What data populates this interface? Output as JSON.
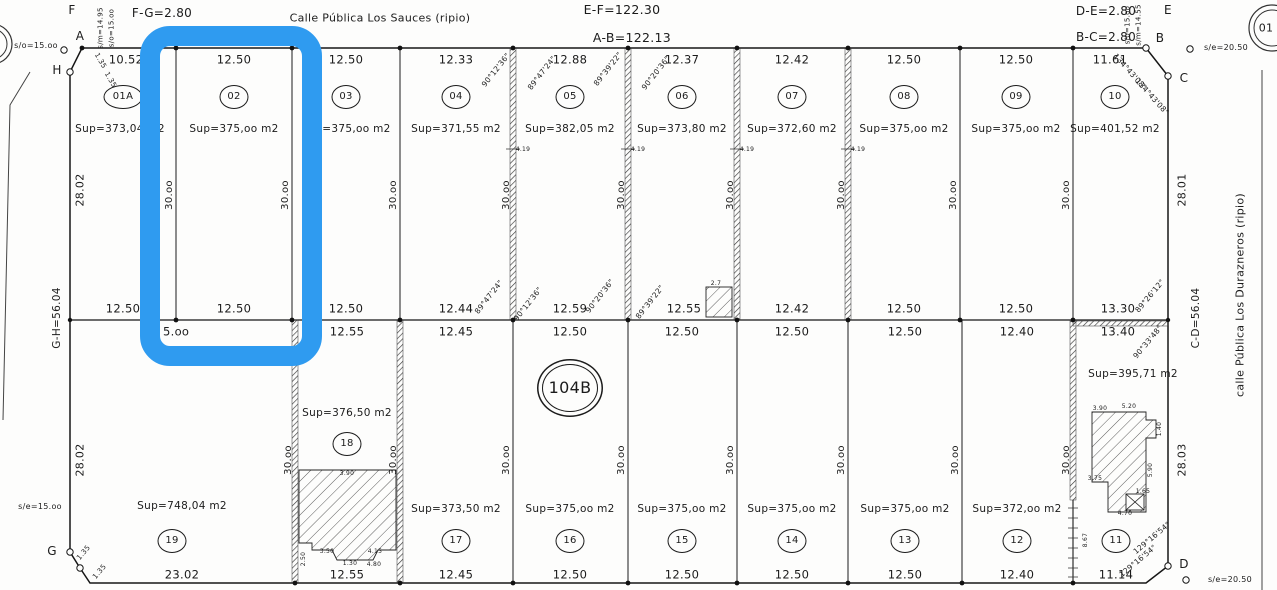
{
  "plan": {
    "block_number": "104B",
    "streets": {
      "top": "Calle Pública Los Sauces (ripio)",
      "right": "calle Pública Los Durazneros (ripio)"
    },
    "perimeter": {
      "ab": "A-B=122.13",
      "ef": "E-F=122.30",
      "gh": "G-H=56.04",
      "cd": "C-D=56.04",
      "fg": "F-G=2.80",
      "bc": "B-C=2.80",
      "de": "D-E=2.80"
    }
  },
  "highlight": {
    "color": "#2f9bf0",
    "target": "lot-02"
  },
  "labels": [
    {
      "n": "vertex-f-label",
      "t": "F",
      "x": 72,
      "y": 10,
      "s": 12
    },
    {
      "n": "dim-f-g",
      "t": "F-G=2.80",
      "x": 162,
      "y": 13,
      "s": 12
    },
    {
      "n": "dim-h-a-partial",
      "t": "H-",
      "x": 199,
      "y": 33,
      "s": 12
    },
    {
      "n": "street-top-label",
      "t": "Calle Pública Los Sauces (ripio)",
      "x": 380,
      "y": 18,
      "s": 11
    },
    {
      "n": "dim-e-f",
      "t": "E-F=122.30",
      "x": 622,
      "y": 10,
      "s": 12.5
    },
    {
      "n": "dim-a-b",
      "t": "A-B=122.13",
      "x": 632,
      "y": 38,
      "s": 12.5
    },
    {
      "n": "dim-d-e",
      "t": "D-E=2.80",
      "x": 1106,
      "y": 11,
      "s": 12
    },
    {
      "n": "dim-b-c",
      "t": "B-C=2.80",
      "x": 1106,
      "y": 37,
      "s": 12
    },
    {
      "n": "vertex-e-label",
      "t": "E",
      "x": 1168,
      "y": 10,
      "s": 12
    },
    {
      "n": "vertex-b-label",
      "t": "B",
      "x": 1160,
      "y": 38,
      "s": 12
    },
    {
      "n": "vertex-c-label",
      "t": "C",
      "x": 1184,
      "y": 78,
      "s": 12
    },
    {
      "n": "vertex-d-label",
      "t": "D",
      "x": 1184,
      "y": 564,
      "s": 12
    },
    {
      "n": "vertex-a-label",
      "t": "A",
      "x": 80,
      "y": 36,
      "s": 12
    },
    {
      "n": "vertex-h-label",
      "t": "H",
      "x": 57,
      "y": 70,
      "s": 12
    },
    {
      "n": "vertex-g-label",
      "t": "G",
      "x": 52,
      "y": 551,
      "s": 12
    },
    {
      "n": "offset-top-left",
      "t": "s/o=15.oo",
      "x": 36,
      "y": 46,
      "s": 8
    },
    {
      "n": "offset-f-1",
      "t": "s/m=14.95",
      "x": 101,
      "y": 28,
      "s": 7,
      "r": -90
    },
    {
      "n": "offset-f-2",
      "t": "s/o=15.oo",
      "x": 112,
      "y": 28,
      "s": 7,
      "r": -90
    },
    {
      "n": "offset-e-1",
      "t": "s/o=15.oo",
      "x": 1128,
      "y": 25,
      "s": 7,
      "r": -90
    },
    {
      "n": "offset-e-2",
      "t": "s/m=14.55",
      "x": 1139,
      "y": 25,
      "s": 7,
      "r": -90
    },
    {
      "n": "offset-top-right",
      "t": "s/e=20.50",
      "x": 1226,
      "y": 48,
      "s": 8
    },
    {
      "n": "offset-bottom-left",
      "t": "s/e=15.oo",
      "x": 40,
      "y": 507,
      "s": 8
    },
    {
      "n": "offset-bottom-right",
      "t": "s/e=20.50",
      "x": 1230,
      "y": 580,
      "s": 8
    },
    {
      "n": "street-right-label",
      "t": "calle Pública Los Durazneros (ripio)",
      "x": 1240,
      "y": 295,
      "s": 11,
      "r": -90
    },
    {
      "n": "adjacent-parcel-number",
      "t": "01",
      "x": 1266,
      "y": 28,
      "s": 11
    },
    {
      "n": "dim-g-h",
      "t": "G-H=56.04",
      "x": 57,
      "y": 318,
      "s": 10.5,
      "r": -90
    },
    {
      "n": "dim-c-d",
      "t": "C-D=56.04",
      "x": 1196,
      "y": 318,
      "s": 10.5,
      "r": -90
    },
    {
      "n": "dim-left-upper",
      "t": "28.02",
      "x": 80,
      "y": 190,
      "s": 11,
      "r": -90
    },
    {
      "n": "dim-left-lower",
      "t": "28.02",
      "x": 80,
      "y": 460,
      "s": 11,
      "r": -90
    },
    {
      "n": "dim-right-upper",
      "t": "28.01",
      "x": 1182,
      "y": 190,
      "s": 11,
      "r": -90
    },
    {
      "n": "dim-right-lower",
      "t": "28.03",
      "x": 1182,
      "y": 460,
      "s": 11,
      "r": -90
    },
    {
      "n": "dim-lot-01A-front",
      "t": "10.52",
      "x": 126,
      "y": 60,
      "s": 11.5
    },
    {
      "n": "dim-lot-02-front",
      "t": "12.50",
      "x": 234,
      "y": 60,
      "s": 11.5
    },
    {
      "n": "dim-lot-03-front",
      "t": "12.50",
      "x": 346,
      "y": 60,
      "s": 11.5
    },
    {
      "n": "dim-lot-04-front",
      "t": "12.33",
      "x": 456,
      "y": 60,
      "s": 11.5
    },
    {
      "n": "dim-lot-05-front",
      "t": "12.88",
      "x": 570,
      "y": 60,
      "s": 11.5
    },
    {
      "n": "dim-lot-06-front",
      "t": "12.37",
      "x": 682,
      "y": 60,
      "s": 11.5
    },
    {
      "n": "dim-lot-07-front",
      "t": "12.42",
      "x": 792,
      "y": 60,
      "s": 11.5
    },
    {
      "n": "dim-lot-08-front",
      "t": "12.50",
      "x": 904,
      "y": 60,
      "s": 11.5
    },
    {
      "n": "dim-lot-09-front",
      "t": "12.50",
      "x": 1016,
      "y": 60,
      "s": 11.5
    },
    {
      "n": "dim-lot-10-front",
      "t": "11.61",
      "x": 1110,
      "y": 60,
      "s": 11.5
    },
    {
      "n": "lot-01A-number",
      "t": "01A",
      "x": 123,
      "y": 97,
      "s": 10,
      "cls": "bub bubw"
    },
    {
      "n": "lot-02-number",
      "t": "02",
      "x": 234,
      "y": 97,
      "s": 10,
      "cls": "bub"
    },
    {
      "n": "lot-03-number",
      "t": "03",
      "x": 346,
      "y": 97,
      "s": 10,
      "cls": "bub"
    },
    {
      "n": "lot-04-number",
      "t": "04",
      "x": 456,
      "y": 97,
      "s": 10,
      "cls": "bub"
    },
    {
      "n": "lot-05-number",
      "t": "05",
      "x": 570,
      "y": 97,
      "s": 10,
      "cls": "bub"
    },
    {
      "n": "lot-06-number",
      "t": "06",
      "x": 682,
      "y": 97,
      "s": 10,
      "cls": "bub"
    },
    {
      "n": "lot-07-number",
      "t": "07",
      "x": 792,
      "y": 97,
      "s": 10,
      "cls": "bub"
    },
    {
      "n": "lot-08-number",
      "t": "08",
      "x": 904,
      "y": 97,
      "s": 10,
      "cls": "bub"
    },
    {
      "n": "lot-09-number",
      "t": "09",
      "x": 1016,
      "y": 97,
      "s": 10,
      "cls": "bub"
    },
    {
      "n": "lot-10-number",
      "t": "10",
      "x": 1115,
      "y": 97,
      "s": 10,
      "cls": "bub"
    },
    {
      "n": "lot-01A-area",
      "t": "Sup=373,04 m2",
      "x": 120,
      "y": 129,
      "s": 10.5
    },
    {
      "n": "lot-02-area",
      "t": "Sup=375,oo m2",
      "x": 234,
      "y": 129,
      "s": 10.5
    },
    {
      "n": "lot-03-area",
      "t": "Sup=375,oo m2",
      "x": 346,
      "y": 129,
      "s": 10.5
    },
    {
      "n": "lot-04-area",
      "t": "Sup=371,55 m2",
      "x": 456,
      "y": 129,
      "s": 10.5
    },
    {
      "n": "lot-05-area",
      "t": "Sup=382,05 m2",
      "x": 570,
      "y": 129,
      "s": 10.5
    },
    {
      "n": "lot-06-area",
      "t": "Sup=373,80 m2",
      "x": 682,
      "y": 129,
      "s": 10.5
    },
    {
      "n": "lot-07-area",
      "t": "Sup=372,60 m2",
      "x": 792,
      "y": 129,
      "s": 10.5
    },
    {
      "n": "lot-08-area",
      "t": "Sup=375,oo m2",
      "x": 904,
      "y": 129,
      "s": 10.5
    },
    {
      "n": "lot-09-area",
      "t": "Sup=375,oo m2",
      "x": 1016,
      "y": 129,
      "s": 10.5
    },
    {
      "n": "lot-10-area",
      "t": "Sup=401,52 m2",
      "x": 1115,
      "y": 129,
      "s": 10.5
    },
    {
      "n": "dim-depth-top-1",
      "t": "30.oo",
      "x": 170,
      "y": 195,
      "s": 10,
      "r": -90
    },
    {
      "n": "dim-depth-top-2",
      "t": "30.oo",
      "x": 286,
      "y": 195,
      "s": 10,
      "r": -90
    },
    {
      "n": "dim-depth-top-3",
      "t": "30.oo",
      "x": 394,
      "y": 195,
      "s": 10,
      "r": -90
    },
    {
      "n": "dim-depth-top-4",
      "t": "30.oo",
      "x": 507,
      "y": 195,
      "s": 10,
      "r": -90
    },
    {
      "n": "dim-depth-top-5",
      "t": "30.oo",
      "x": 622,
      "y": 195,
      "s": 10,
      "r": -90
    },
    {
      "n": "dim-depth-top-6",
      "t": "30.oo",
      "x": 731,
      "y": 195,
      "s": 10,
      "r": -90
    },
    {
      "n": "dim-depth-top-7",
      "t": "30.oo",
      "x": 842,
      "y": 195,
      "s": 10,
      "r": -90
    },
    {
      "n": "dim-depth-top-8",
      "t": "30.oo",
      "x": 954,
      "y": 195,
      "s": 10,
      "r": -90
    },
    {
      "n": "dim-depth-top-9",
      "t": "30.oo",
      "x": 1067,
      "y": 195,
      "s": 10,
      "r": -90
    },
    {
      "n": "dim-lot-01A-back",
      "t": "12.50",
      "x": 123,
      "y": 309,
      "s": 11.5
    },
    {
      "n": "dim-lot-02-back",
      "t": "12.50",
      "x": 234,
      "y": 309,
      "s": 11.5
    },
    {
      "n": "dim-lot-03-back",
      "t": "12.50",
      "x": 346,
      "y": 309,
      "s": 11.5
    },
    {
      "n": "dim-lot-04-back",
      "t": "12.44",
      "x": 456,
      "y": 309,
      "s": 11.5
    },
    {
      "n": "dim-lot-05-back",
      "t": "12.59",
      "x": 570,
      "y": 309,
      "s": 11.5
    },
    {
      "n": "dim-lot-06-back",
      "t": "12.55",
      "x": 684,
      "y": 309,
      "s": 11.5
    },
    {
      "n": "dim-lot-07-back",
      "t": "12.42",
      "x": 792,
      "y": 309,
      "s": 11.5
    },
    {
      "n": "dim-lot-08-back",
      "t": "12.50",
      "x": 904,
      "y": 309,
      "s": 11.5
    },
    {
      "n": "dim-lot-09-back",
      "t": "12.50",
      "x": 1016,
      "y": 309,
      "s": 11.5
    },
    {
      "n": "dim-lot-10-back",
      "t": "13.30",
      "x": 1118,
      "y": 309,
      "s": 11.5
    },
    {
      "n": "dim-lot-19-back-partial",
      "t": "5.oo",
      "x": 163,
      "y": 332,
      "s": 11.5,
      "a": "l"
    },
    {
      "n": "dim-lot-18-back",
      "t": "12.55",
      "x": 347,
      "y": 332,
      "s": 11.5
    },
    {
      "n": "dim-lot-17-back",
      "t": "12.45",
      "x": 456,
      "y": 332,
      "s": 11.5
    },
    {
      "n": "dim-lot-16-back",
      "t": "12.50",
      "x": 570,
      "y": 332,
      "s": 11.5
    },
    {
      "n": "dim-lot-15-back",
      "t": "12.50",
      "x": 682,
      "y": 332,
      "s": 11.5
    },
    {
      "n": "dim-lot-14-back",
      "t": "12.50",
      "x": 792,
      "y": 332,
      "s": 11.5
    },
    {
      "n": "dim-lot-13-back",
      "t": "12.50",
      "x": 905,
      "y": 332,
      "s": 11.5
    },
    {
      "n": "dim-lot-12-back",
      "t": "12.40",
      "x": 1017,
      "y": 332,
      "s": 11.5
    },
    {
      "n": "dim-lot-11-back",
      "t": "13.40",
      "x": 1118,
      "y": 332,
      "s": 11.5
    },
    {
      "n": "block-number",
      "t": "104B",
      "x": 570,
      "y": 388,
      "s": 16,
      "cls": "bub bub104"
    },
    {
      "n": "lot-18-area",
      "t": "Sup=376,50 m2",
      "x": 347,
      "y": 413,
      "s": 10.5
    },
    {
      "n": "lot-18-number",
      "t": "18",
      "x": 347,
      "y": 444,
      "s": 10,
      "cls": "bub"
    },
    {
      "n": "lot-11-area",
      "t": "Sup=395,71 m2",
      "x": 1133,
      "y": 374,
      "s": 10.5
    },
    {
      "n": "dim-depth-bottom-1",
      "t": "30.oo",
      "x": 289,
      "y": 460,
      "s": 10,
      "r": -90
    },
    {
      "n": "dim-depth-bottom-2",
      "t": "30.oo",
      "x": 394,
      "y": 460,
      "s": 10,
      "r": -90
    },
    {
      "n": "dim-depth-bottom-3",
      "t": "30.oo",
      "x": 507,
      "y": 460,
      "s": 10,
      "r": -90
    },
    {
      "n": "dim-depth-bottom-4",
      "t": "30.oo",
      "x": 622,
      "y": 460,
      "s": 10,
      "r": -90
    },
    {
      "n": "dim-depth-bottom-5",
      "t": "30.oo",
      "x": 731,
      "y": 460,
      "s": 10,
      "r": -90
    },
    {
      "n": "dim-depth-bottom-6",
      "t": "30.oo",
      "x": 842,
      "y": 460,
      "s": 10,
      "r": -90
    },
    {
      "n": "dim-depth-bottom-7",
      "t": "30.oo",
      "x": 956,
      "y": 460,
      "s": 10,
      "r": -90
    },
    {
      "n": "dim-depth-bottom-8",
      "t": "30.oo",
      "x": 1067,
      "y": 460,
      "s": 10,
      "r": -90
    },
    {
      "n": "lot-19-area",
      "t": "Sup=748,04 m2",
      "x": 182,
      "y": 506,
      "s": 10.5
    },
    {
      "n": "lot-17-area",
      "t": "Sup=373,50 m2",
      "x": 456,
      "y": 509,
      "s": 10.5
    },
    {
      "n": "lot-16-area",
      "t": "Sup=375,oo m2",
      "x": 570,
      "y": 509,
      "s": 10.5
    },
    {
      "n": "lot-15-area",
      "t": "Sup=375,oo m2",
      "x": 682,
      "y": 509,
      "s": 10.5
    },
    {
      "n": "lot-14-area",
      "t": "Sup=375,oo m2",
      "x": 792,
      "y": 509,
      "s": 10.5
    },
    {
      "n": "lot-13-area",
      "t": "Sup=375,oo m2",
      "x": 905,
      "y": 509,
      "s": 10.5
    },
    {
      "n": "lot-12-area",
      "t": "Sup=372,oo m2",
      "x": 1017,
      "y": 509,
      "s": 10.5
    },
    {
      "n": "lot-19-number",
      "t": "19",
      "x": 172,
      "y": 541,
      "s": 10,
      "cls": "bub"
    },
    {
      "n": "lot-17-number",
      "t": "17",
      "x": 456,
      "y": 541,
      "s": 10,
      "cls": "bub"
    },
    {
      "n": "lot-16-number",
      "t": "16",
      "x": 570,
      "y": 541,
      "s": 10,
      "cls": "bub"
    },
    {
      "n": "lot-15-number",
      "t": "15",
      "x": 682,
      "y": 541,
      "s": 10,
      "cls": "bub"
    },
    {
      "n": "lot-14-number",
      "t": "14",
      "x": 792,
      "y": 541,
      "s": 10,
      "cls": "bub"
    },
    {
      "n": "lot-13-number",
      "t": "13",
      "x": 905,
      "y": 541,
      "s": 10,
      "cls": "bub"
    },
    {
      "n": "lot-12-number",
      "t": "12",
      "x": 1017,
      "y": 541,
      "s": 10,
      "cls": "bub"
    },
    {
      "n": "lot-11-number",
      "t": "11",
      "x": 1116,
      "y": 541,
      "s": 10,
      "cls": "bub"
    },
    {
      "n": "dim-lot-19-front",
      "t": "23.02",
      "x": 182,
      "y": 575,
      "s": 11.5
    },
    {
      "n": "dim-lot-18-front",
      "t": "12.55",
      "x": 347,
      "y": 575,
      "s": 11.5
    },
    {
      "n": "dim-lot-17-front",
      "t": "12.45",
      "x": 456,
      "y": 575,
      "s": 11.5
    },
    {
      "n": "dim-lot-16-front",
      "t": "12.50",
      "x": 570,
      "y": 575,
      "s": 11.5
    },
    {
      "n": "dim-lot-15-front",
      "t": "12.50",
      "x": 682,
      "y": 575,
      "s": 11.5
    },
    {
      "n": "dim-lot-14-front",
      "t": "12.50",
      "x": 792,
      "y": 575,
      "s": 11.5
    },
    {
      "n": "dim-lot-13-front",
      "t": "12.50",
      "x": 905,
      "y": 575,
      "s": 11.5
    },
    {
      "n": "dim-lot-12-front",
      "t": "12.40",
      "x": 1017,
      "y": 575,
      "s": 11.5
    },
    {
      "n": "dim-lot-11-front",
      "t": "11.14",
      "x": 1116,
      "y": 575,
      "s": 11.5
    },
    {
      "n": "angle-top-1",
      "t": "90°12'36\"",
      "x": 496,
      "y": 70,
      "s": 7.5,
      "r": -52
    },
    {
      "n": "angle-top-2",
      "t": "89°47'24\"",
      "x": 542,
      "y": 73,
      "s": 7.5,
      "r": -52
    },
    {
      "n": "angle-top-3",
      "t": "89°39'22\"",
      "x": 608,
      "y": 69,
      "s": 7.5,
      "r": -52
    },
    {
      "n": "angle-top-4",
      "t": "90°20'36\"",
      "x": 656,
      "y": 73,
      "s": 7.5,
      "r": -52
    },
    {
      "n": "angle-b-1",
      "t": "134°43'08\"",
      "x": 1130,
      "y": 72,
      "s": 7.5,
      "r": 48
    },
    {
      "n": "angle-b-2",
      "t": "134°43'08\"",
      "x": 1152,
      "y": 97,
      "s": 7.5,
      "r": 48
    },
    {
      "n": "angle-mid-1",
      "t": "89°47'24\"",
      "x": 489,
      "y": 297,
      "s": 7.5,
      "r": -52
    },
    {
      "n": "angle-mid-2",
      "t": "90°12'36\"",
      "x": 528,
      "y": 304,
      "s": 7.5,
      "r": -52
    },
    {
      "n": "angle-mid-3",
      "t": "90°20'36\"",
      "x": 600,
      "y": 296,
      "s": 7.5,
      "r": -52
    },
    {
      "n": "angle-mid-4",
      "t": "89°39'22\"",
      "x": 650,
      "y": 302,
      "s": 7.5,
      "r": -52
    },
    {
      "n": "angle-mid-right-1",
      "t": "89°26'12\"",
      "x": 1150,
      "y": 296,
      "s": 7.5,
      "r": -50
    },
    {
      "n": "angle-mid-right-2",
      "t": "90°33'48\"",
      "x": 1148,
      "y": 342,
      "s": 7.5,
      "r": -50
    },
    {
      "n": "angle-d-1",
      "t": "129°16'54\"",
      "x": 1152,
      "y": 538,
      "s": 7.5,
      "r": -40
    },
    {
      "n": "angle-d-2",
      "t": "129°16'54\"",
      "x": 1138,
      "y": 561,
      "s": 7.5,
      "r": -40
    },
    {
      "n": "chamfer-a-1",
      "t": "1.35",
      "x": 100,
      "y": 61,
      "s": 7,
      "r": 60
    },
    {
      "n": "chamfer-a-2",
      "t": "1.35",
      "x": 110,
      "y": 80,
      "s": 7,
      "r": 60
    },
    {
      "n": "chamfer-g-1",
      "t": "1.35",
      "x": 84,
      "y": 553,
      "s": 7,
      "r": -50
    },
    {
      "n": "chamfer-g-2",
      "t": "1.35",
      "x": 100,
      "y": 572,
      "s": 7,
      "r": -50
    },
    {
      "n": "tick-dim-1",
      "t": "4.19",
      "x": 523,
      "y": 150,
      "s": 6
    },
    {
      "n": "tick-dim-2",
      "t": "4.19",
      "x": 638,
      "y": 150,
      "s": 6
    },
    {
      "n": "tick-dim-3",
      "t": "4.19",
      "x": 747,
      "y": 150,
      "s": 6
    },
    {
      "n": "tick-dim-4",
      "t": "4.19",
      "x": 858,
      "y": 150,
      "s": 6
    },
    {
      "n": "mejora-dim",
      "t": "2.7",
      "x": 716,
      "y": 284,
      "s": 6
    },
    {
      "n": "dim-8-67",
      "t": "8.67",
      "x": 1086,
      "y": 540,
      "s": 6,
      "r": -90
    },
    {
      "n": "bldg18-dim-1",
      "t": "3.90",
      "x": 347,
      "y": 474,
      "s": 6
    },
    {
      "n": "bldg18-dim-2",
      "t": "2.50",
      "x": 304,
      "y": 559,
      "s": 6,
      "r": -90
    },
    {
      "n": "bldg18-dim-3",
      "t": "3.50",
      "x": 327,
      "y": 552,
      "s": 6
    },
    {
      "n": "bldg18-dim-4",
      "t": "1.30",
      "x": 350,
      "y": 564,
      "s": 6
    },
    {
      "n": "bldg18-dim-5",
      "t": "4.15",
      "x": 375,
      "y": 552,
      "s": 6
    },
    {
      "n": "bldg18-dim-6",
      "t": "4.80",
      "x": 374,
      "y": 565,
      "s": 6
    },
    {
      "n": "bldg11-dim-1",
      "t": "3.90",
      "x": 1100,
      "y": 409,
      "s": 6
    },
    {
      "n": "bldg11-dim-2",
      "t": "5.20",
      "x": 1129,
      "y": 407,
      "s": 6
    },
    {
      "n": "bldg11-dim-3",
      "t": "1.40",
      "x": 1160,
      "y": 429,
      "s": 6,
      "r": -90
    },
    {
      "n": "bldg11-dim-4",
      "t": "3.75",
      "x": 1095,
      "y": 479,
      "s": 6
    },
    {
      "n": "bldg11-dim-5",
      "t": "4.70",
      "x": 1125,
      "y": 514,
      "s": 6
    },
    {
      "n": "bldg11-dim-6",
      "t": "1.65",
      "x": 1143,
      "y": 492,
      "s": 6
    },
    {
      "n": "bldg11-dim-7",
      "t": "5.90",
      "x": 1151,
      "y": 470,
      "s": 6,
      "r": -90
    }
  ]
}
